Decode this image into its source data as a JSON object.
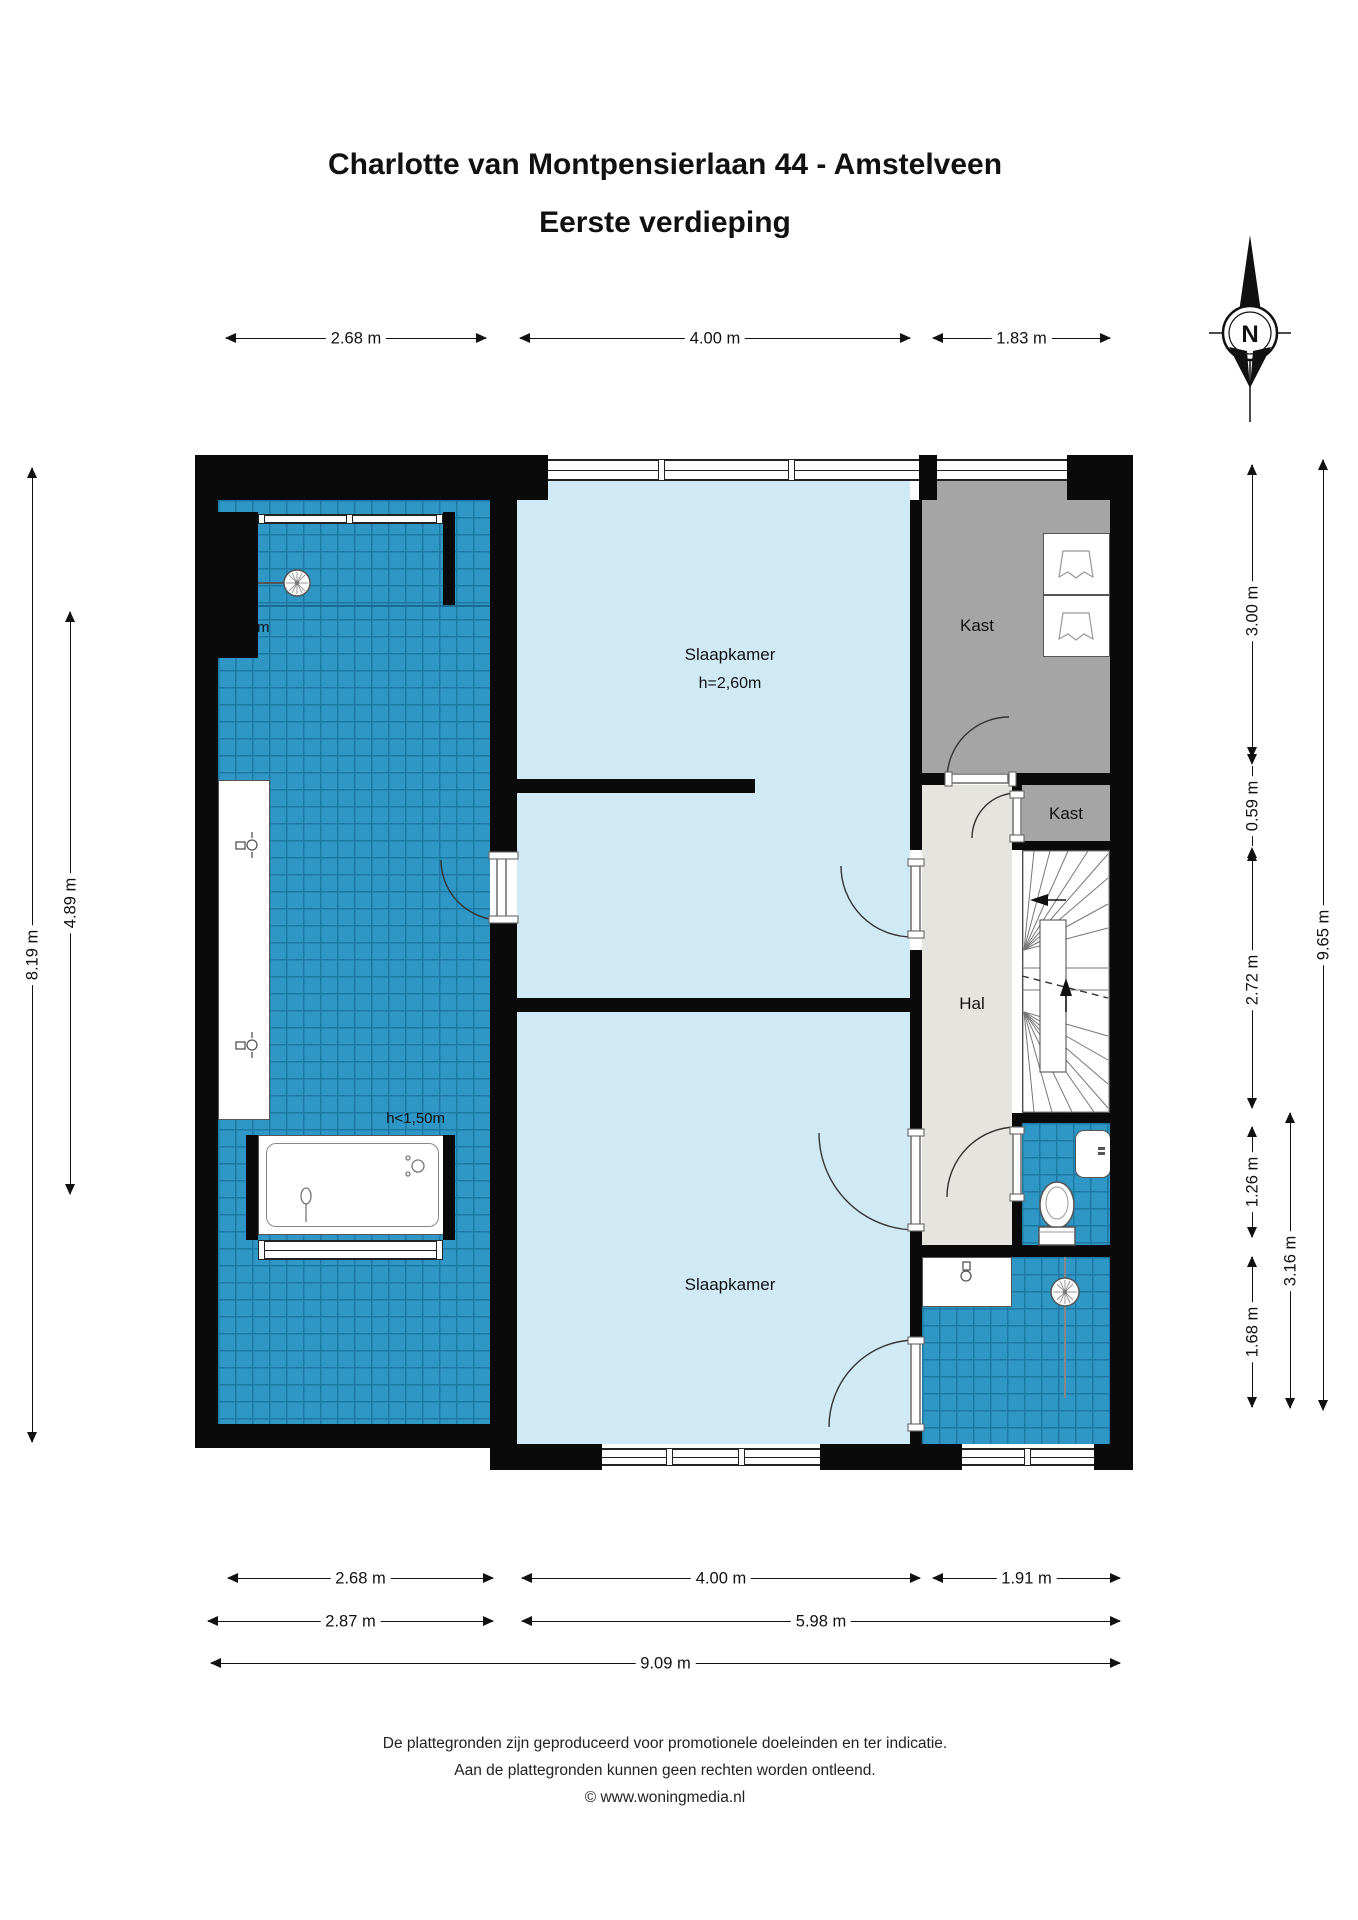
{
  "title": {
    "line1": "Charlotte van Montpensierlaan 44 - Amstelveen",
    "line2": "Eerste verdieping"
  },
  "compass": {
    "label": "N"
  },
  "rooms": {
    "bedroom_top": {
      "label": "Slaapkamer",
      "height_note": "h=2,60m"
    },
    "bedroom_bottom": {
      "label": "Slaapkamer"
    },
    "hall": {
      "label": "Hal"
    },
    "closet_large": {
      "label": "Kast"
    },
    "closet_small": {
      "label": "Kast"
    }
  },
  "annotations": {
    "attic_top": "<1,50m",
    "attic_bottom": "h<1,50m"
  },
  "dims": {
    "top": [
      "2.68 m",
      "4.00 m",
      "1.83 m"
    ],
    "left": [
      "8.19 m",
      "4.89 m"
    ],
    "right": [
      "3.00 m",
      "0.59 m",
      "2.72 m",
      "1.26 m",
      "1.68 m",
      "3.16 m",
      "9.65 m"
    ],
    "bottom1": [
      "2.68 m",
      "4.00 m",
      "1.91 m"
    ],
    "bottom2": [
      "2.87 m",
      "5.98 m"
    ],
    "bottom3": [
      "9.09 m"
    ]
  },
  "footer": {
    "line1": "De plattegronden zijn geproduceerd voor promotionele doeleinden en ter indicatie.",
    "line2": "Aan de plattegronden kunnen geen rechten worden ontleend.",
    "line3": "© www.woningmedia.nl"
  },
  "colors": {
    "wall": "#0a0a0a",
    "tile_blue": "#2e97c5",
    "tile_grid": "#1e78a4",
    "room_blue": "#cfe9f5",
    "hall_gray": "#e6e4df",
    "closet_gray": "#a5a5a5"
  }
}
